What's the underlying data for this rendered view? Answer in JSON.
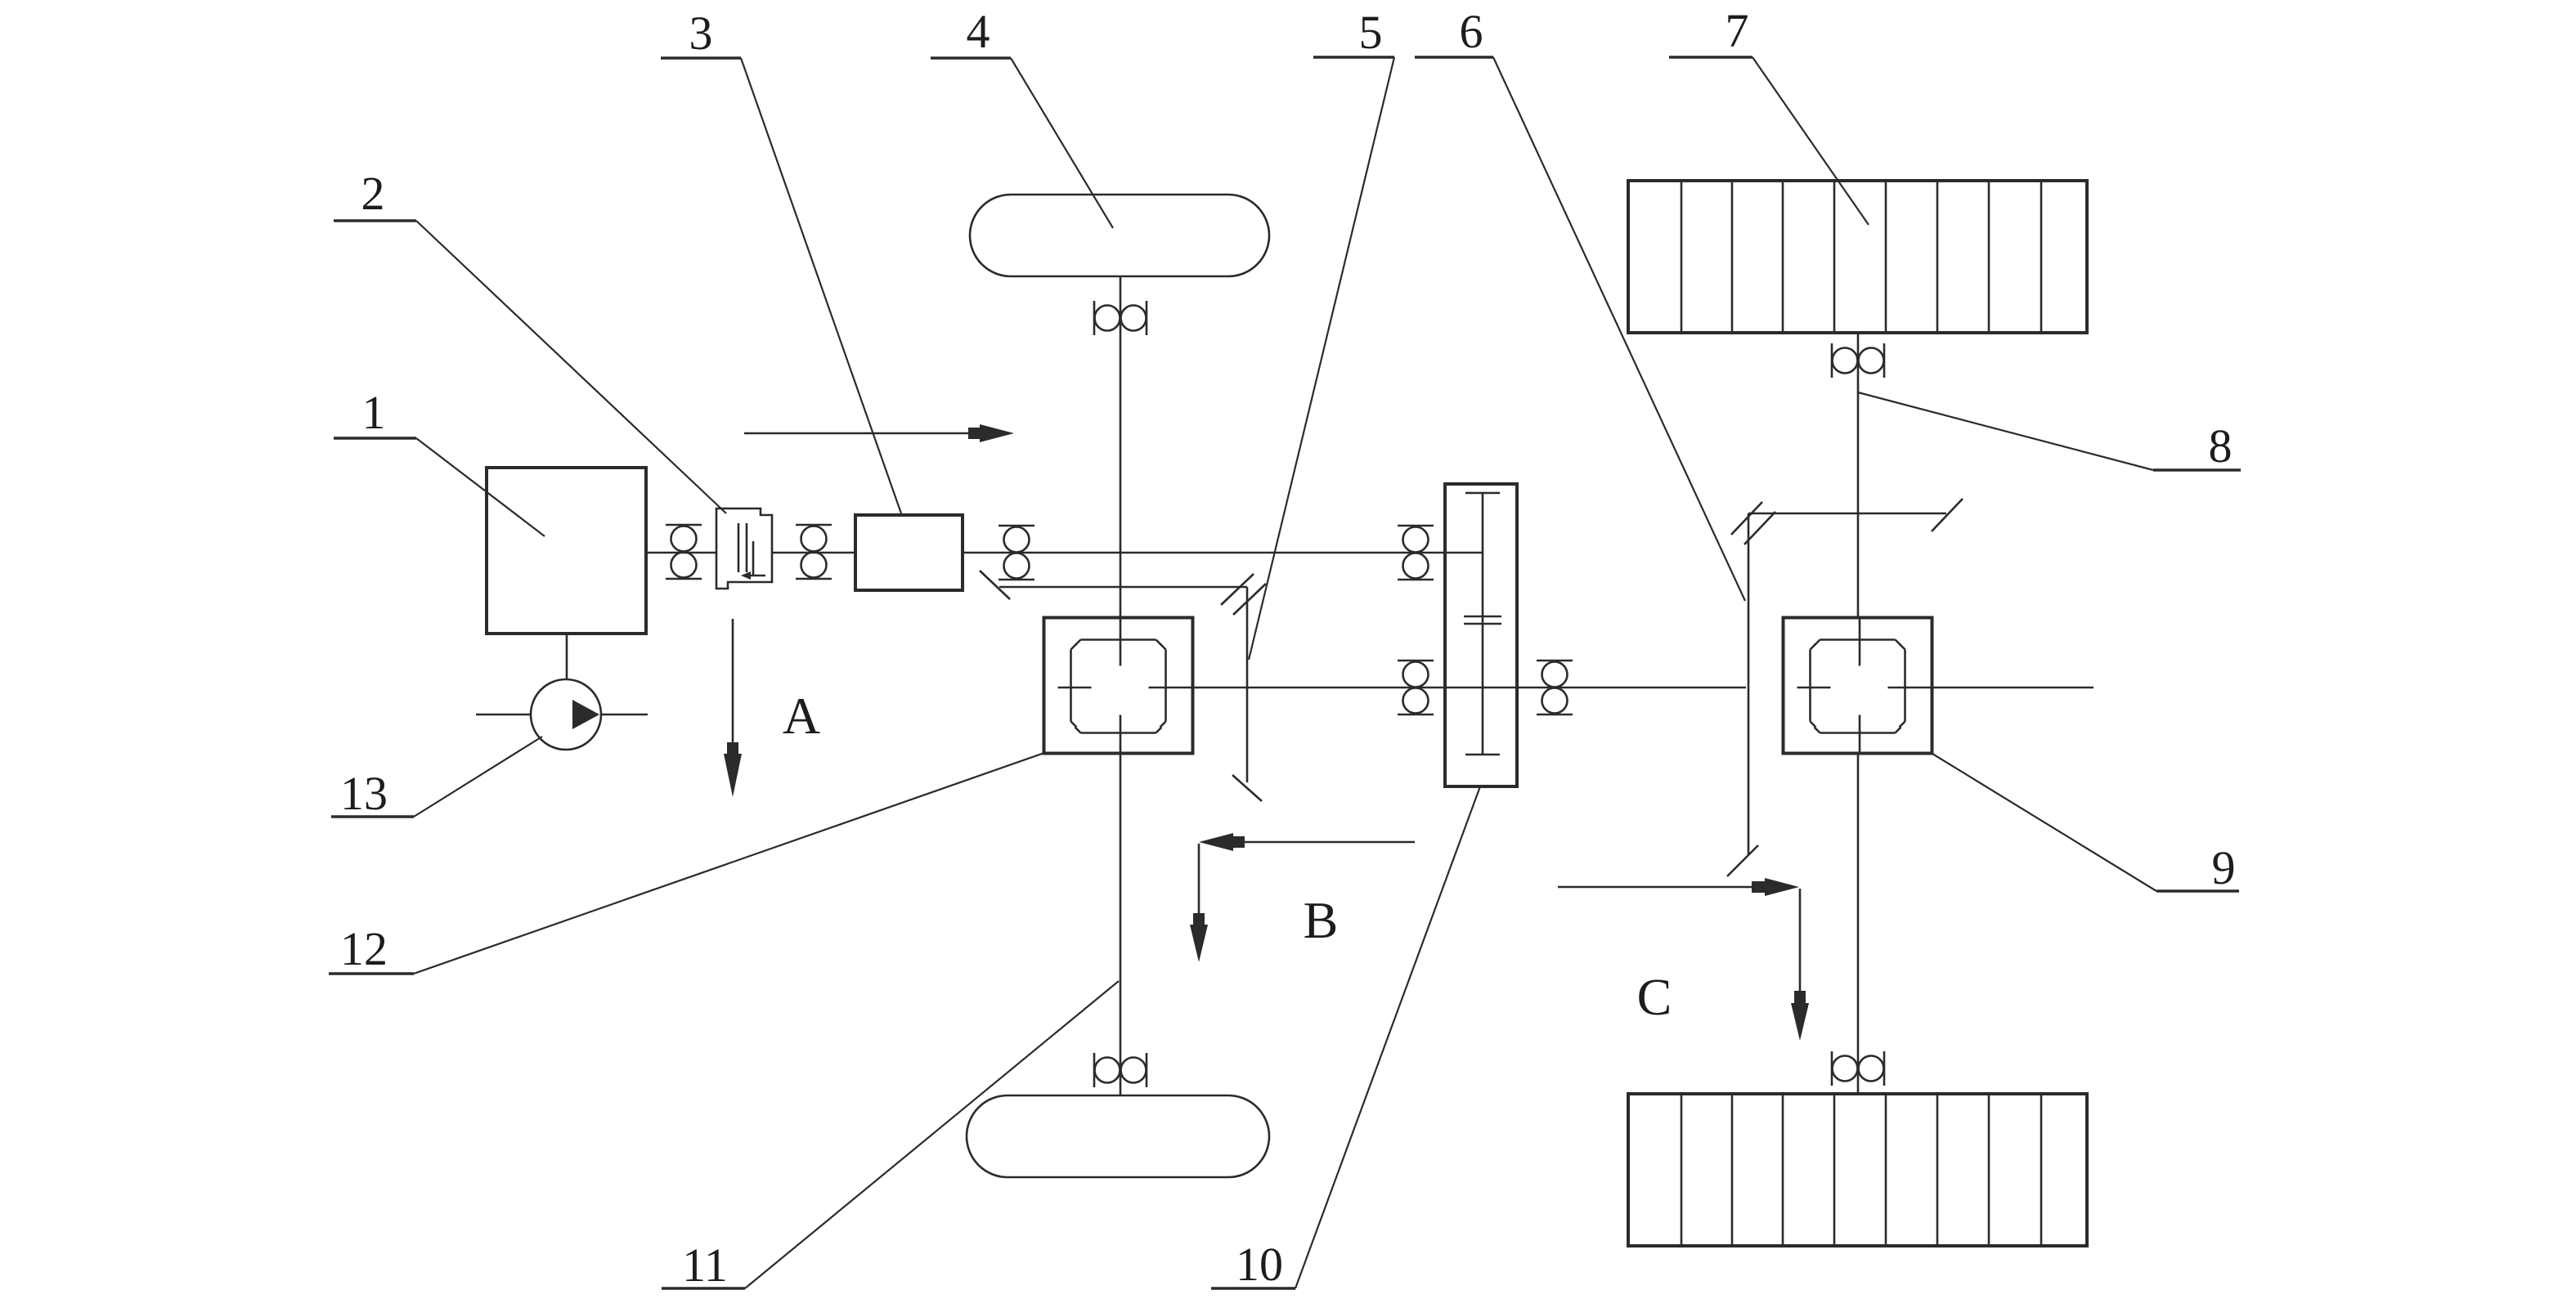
{
  "figure": {
    "kind": "vehicle-drivetrain-schematic",
    "background_color": "#ffffff",
    "line_color": "#2b2b2b",
    "text_color": "#1d1d1d"
  },
  "part_labels": {
    "l1": "1",
    "l2": "2",
    "l3": "3",
    "l4": "4",
    "l5": "5",
    "l6": "6",
    "l7": "7",
    "l8": "8",
    "l9": "9",
    "l10": "10",
    "l11": "11",
    "l12": "12",
    "l13": "13"
  },
  "section_labels": {
    "a": "A",
    "b": "B",
    "c": "C"
  }
}
